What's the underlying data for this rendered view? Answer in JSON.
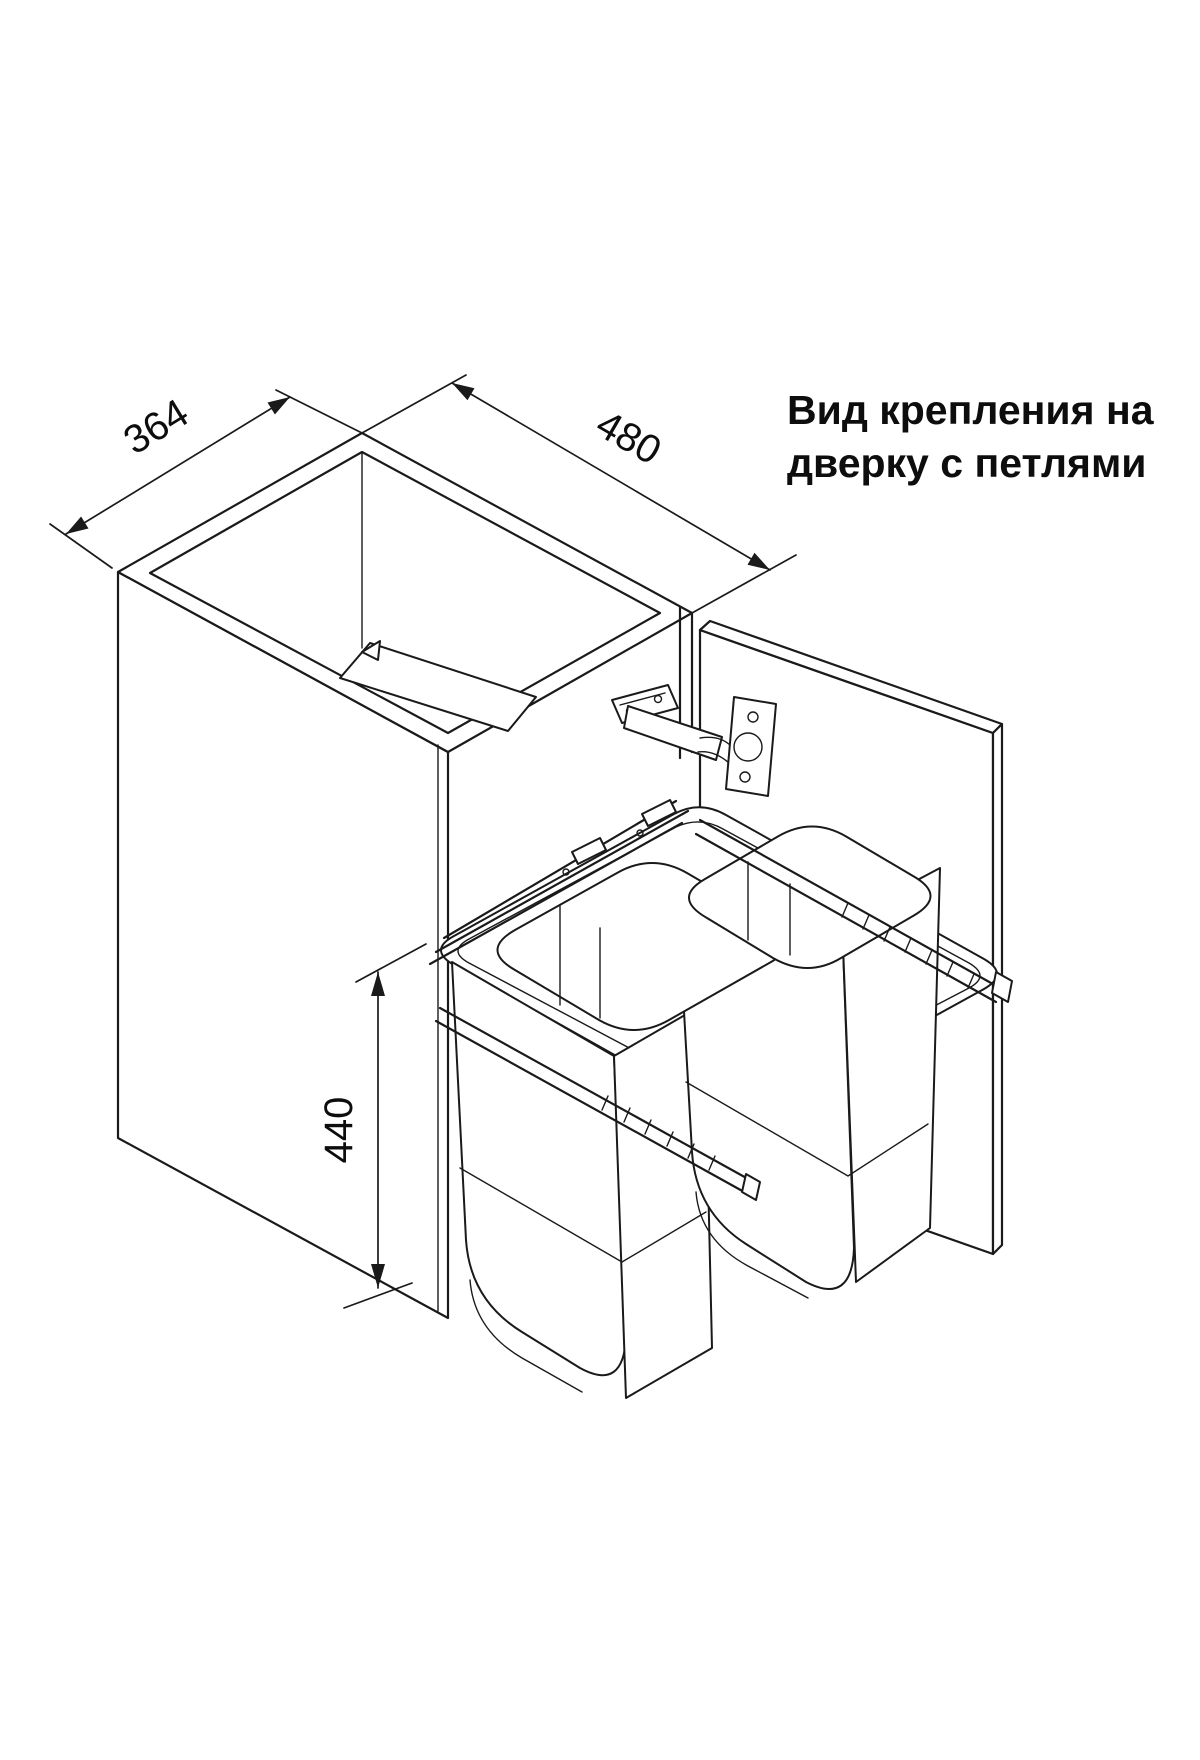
{
  "title": {
    "line1": "Вид крепления на",
    "line2": "дверку с петлями"
  },
  "dimensions": {
    "width_mm": "364",
    "depth_mm": "480",
    "height_mm": "440"
  },
  "drawing": {
    "type": "isometric line drawing",
    "subject": "pull-out double waste bin unit inside base cabinet with hinged door",
    "colors": {
      "line": "#1a1a1a",
      "background": "#ffffff",
      "text": "#0d0d0d"
    }
  }
}
